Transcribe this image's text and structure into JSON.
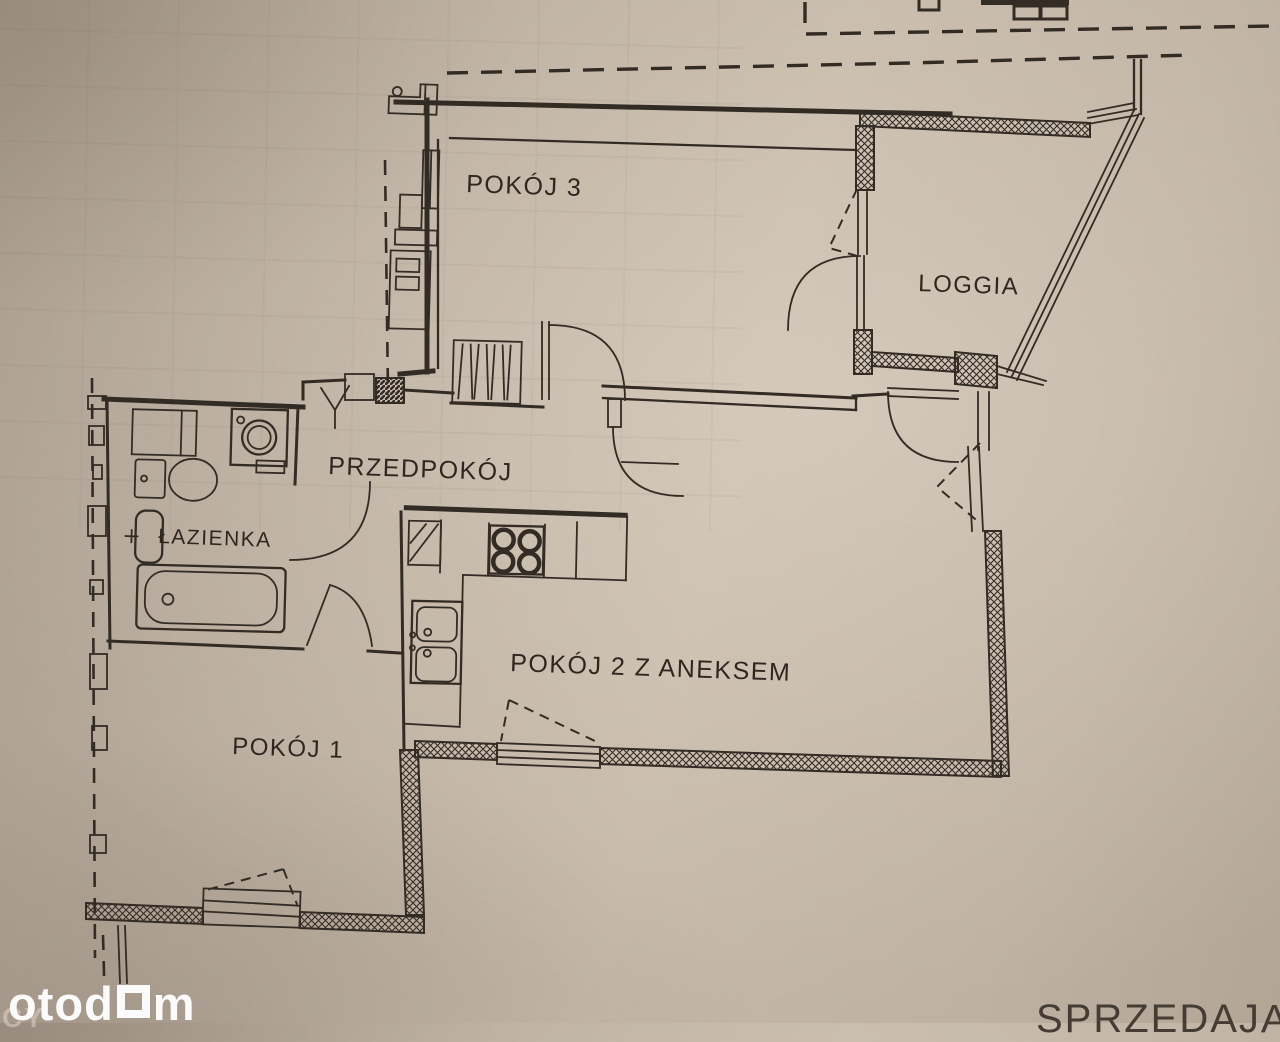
{
  "page": {
    "type": "apartment-floor-plan-photo",
    "language": "pl"
  },
  "colors": {
    "paper": "#c0b3a4",
    "ink": "#332c25",
    "watermark": "#ffffff",
    "seller_text": "#453c34"
  },
  "rooms": [
    {
      "id": "pokoj-3",
      "label": "POKÓJ 3",
      "fixtures": [
        "wardrobe",
        "radiator",
        "balcony-door"
      ]
    },
    {
      "id": "loggia",
      "label": "LOGGIA",
      "fixtures": [
        "railing"
      ]
    },
    {
      "id": "przedpokoj",
      "label": "PRZEDPOKÓJ",
      "fixtures": [
        "tv-antenna-symbol",
        "shaft"
      ]
    },
    {
      "id": "lazienka",
      "label": "ŁAZIENKA",
      "fixtures": [
        "bathtub",
        "toilet",
        "washbasin",
        "washing-machine",
        "cabinet"
      ]
    },
    {
      "id": "pokoj-2-z-aneksem",
      "label": "POKÓJ 2 Z ANEKSEM",
      "fixtures": [
        "stove",
        "kitchen-sink",
        "counter",
        "window",
        "balcony-door"
      ]
    },
    {
      "id": "pokoj-1",
      "label": "POKÓJ 1",
      "fixtures": [
        "window"
      ]
    }
  ],
  "watermark": {
    "prefix": "otod",
    "suffix": "m"
  },
  "bottom": {
    "seller_label": "SPRZEDAJĄCY",
    "corner_fragment": "CY"
  }
}
